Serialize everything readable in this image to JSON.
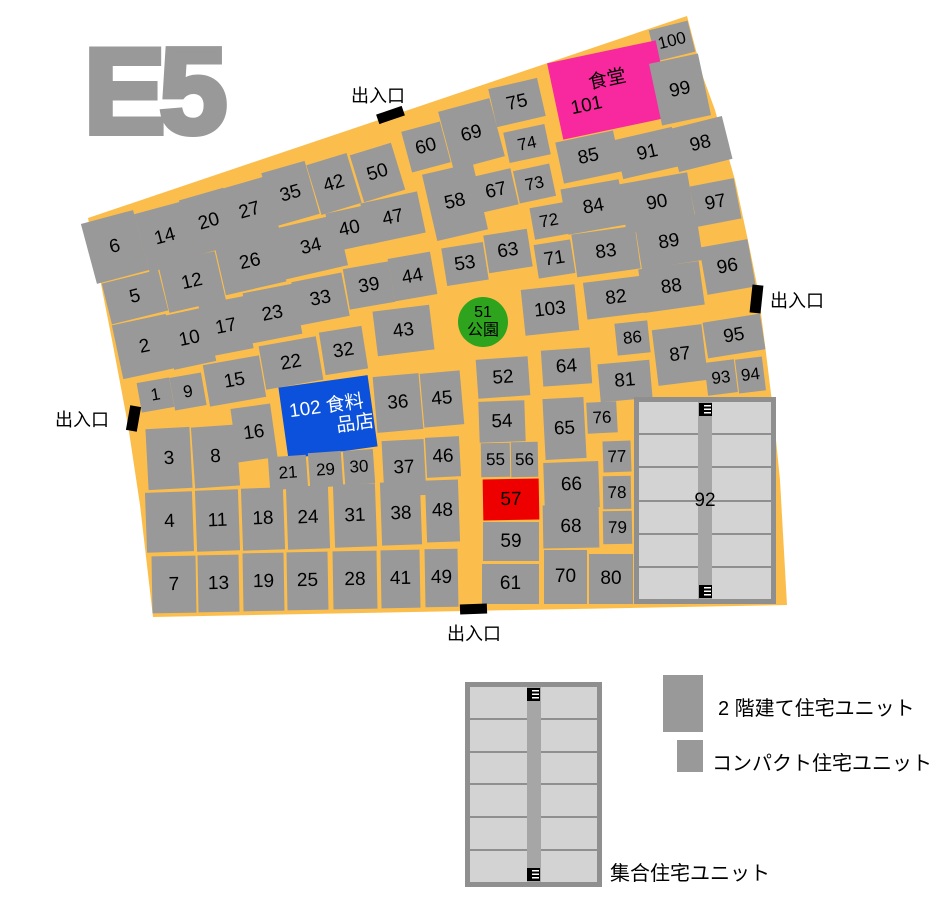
{
  "title": "E5",
  "map": {
    "colors": {
      "street": "#FBBE4D",
      "block": "#999999",
      "park": "#2EA31E",
      "canteen": "#F8289E",
      "grocery": "#0B51DB",
      "highlight": "#EE0000",
      "collective_fill": "#D3D3D3",
      "collective_border": "#8F8F8F",
      "corridor": "#A6A6A6"
    },
    "outline": "88,218 687,16 703,77 715,110 735,180 750,250 758,290 766,353 773,410 780,480 787,605 465,611 153,617 140,505 128,425 112,340",
    "entrance_label": "出入口",
    "entrances": [
      {
        "side": "top",
        "tx": 351,
        "ty": 82,
        "bx": 377,
        "by": 110,
        "bw": 27,
        "bh": 10,
        "br": -19
      },
      {
        "side": "left",
        "tx": 55,
        "ty": 406,
        "bx": 128,
        "by": 406,
        "bw": 11,
        "bh": 25,
        "br": 10
      },
      {
        "side": "right",
        "tx": 770,
        "ty": 287,
        "bx": 751,
        "by": 285,
        "bw": 11,
        "bh": 28,
        "br": 6
      },
      {
        "side": "bottom",
        "tx": 447,
        "ty": 620,
        "bx": 460,
        "by": 604,
        "bw": 27,
        "bh": 10,
        "br": -2
      }
    ],
    "blocks": [
      {
        "l": "6",
        "x": 88,
        "y": 216,
        "w": 54,
        "h": 62,
        "r": -15
      },
      {
        "l": "14",
        "x": 141,
        "y": 207,
        "w": 48,
        "h": 60,
        "r": -15
      },
      {
        "l": "20",
        "x": 186,
        "y": 193,
        "w": 46,
        "h": 58,
        "r": -16
      },
      {
        "l": "27",
        "x": 226,
        "y": 182,
        "w": 47,
        "h": 57,
        "r": -16
      },
      {
        "l": "35",
        "x": 268,
        "y": 166,
        "w": 45,
        "h": 55,
        "r": -16
      },
      {
        "l": "42",
        "x": 313,
        "y": 158,
        "w": 42,
        "h": 52,
        "r": -17
      },
      {
        "l": "50",
        "x": 356,
        "y": 148,
        "w": 43,
        "h": 49,
        "r": -17
      },
      {
        "l": "60",
        "x": 406,
        "y": 126,
        "w": 40,
        "h": 42,
        "r": -15
      },
      {
        "l": "69",
        "x": 445,
        "y": 104,
        "w": 53,
        "h": 60,
        "r": -15
      },
      {
        "l": "75",
        "x": 492,
        "y": 83,
        "w": 50,
        "h": 39,
        "r": -13
      },
      {
        "l": "100",
        "x": 652,
        "y": 25,
        "w": 40,
        "h": 32,
        "r": -14,
        "fs": 17
      },
      {
        "l": "101",
        "x": 554,
        "y": 51,
        "w": 111,
        "h": 78,
        "r": -12,
        "c": "canteen",
        "lines": [
          "食堂",
          "101"
        ],
        "align": [
          "center",
          "left"
        ],
        "name": "canteen-block-101"
      },
      {
        "l": "99",
        "x": 655,
        "y": 58,
        "w": 50,
        "h": 63,
        "r": -12
      },
      {
        "l": "5",
        "x": 106,
        "y": 276,
        "w": 58,
        "h": 42,
        "r": -14
      },
      {
        "l": "12",
        "x": 163,
        "y": 257,
        "w": 58,
        "h": 50,
        "r": -13
      },
      {
        "l": "26",
        "x": 219,
        "y": 234,
        "w": 62,
        "h": 55,
        "r": -13
      },
      {
        "l": "34",
        "x": 279,
        "y": 221,
        "w": 64,
        "h": 52,
        "r": -13
      },
      {
        "l": "40",
        "x": 329,
        "y": 209,
        "w": 41,
        "h": 39,
        "r": -12
      },
      {
        "l": "47",
        "x": 364,
        "y": 197,
        "w": 58,
        "h": 42,
        "r": -12
      },
      {
        "l": "58",
        "x": 429,
        "y": 168,
        "w": 52,
        "h": 68,
        "r": -13
      },
      {
        "l": "67",
        "x": 477,
        "y": 172,
        "w": 38,
        "h": 37,
        "r": -13
      },
      {
        "l": "74",
        "x": 506,
        "y": 128,
        "w": 42,
        "h": 31,
        "r": -12,
        "fs": 17
      },
      {
        "l": "73",
        "x": 516,
        "y": 167,
        "w": 37,
        "h": 33,
        "r": -12,
        "fs": 17
      },
      {
        "l": "2",
        "x": 117,
        "y": 319,
        "w": 55,
        "h": 55,
        "r": -12
      },
      {
        "l": "10",
        "x": 168,
        "y": 311,
        "w": 43,
        "h": 55,
        "r": -12
      },
      {
        "l": "17",
        "x": 203,
        "y": 300,
        "w": 46,
        "h": 53,
        "r": -11
      },
      {
        "l": "23",
        "x": 247,
        "y": 288,
        "w": 51,
        "h": 51,
        "r": -11
      },
      {
        "l": "33",
        "x": 295,
        "y": 277,
        "w": 51,
        "h": 44,
        "r": -11
      },
      {
        "l": "39",
        "x": 346,
        "y": 265,
        "w": 46,
        "h": 41,
        "r": -10
      },
      {
        "l": "44",
        "x": 391,
        "y": 255,
        "w": 43,
        "h": 43,
        "r": -10
      },
      {
        "l": "53",
        "x": 444,
        "y": 245,
        "w": 42,
        "h": 38,
        "r": -9
      },
      {
        "l": "63",
        "x": 486,
        "y": 232,
        "w": 44,
        "h": 38,
        "r": -9
      },
      {
        "l": "72",
        "x": 532,
        "y": 205,
        "w": 34,
        "h": 32,
        "r": -10,
        "fs": 17
      },
      {
        "l": "71",
        "x": 536,
        "y": 242,
        "w": 37,
        "h": 34,
        "r": -9
      },
      {
        "l": "85",
        "x": 559,
        "y": 136,
        "w": 59,
        "h": 42,
        "r": -12
      },
      {
        "l": "91",
        "x": 618,
        "y": 133,
        "w": 59,
        "h": 40,
        "r": -13
      },
      {
        "l": "98",
        "x": 673,
        "y": 122,
        "w": 55,
        "h": 44,
        "r": -14
      },
      {
        "l": "84",
        "x": 564,
        "y": 184,
        "w": 59,
        "h": 46,
        "r": -10
      },
      {
        "l": "90",
        "x": 622,
        "y": 178,
        "w": 70,
        "h": 50,
        "r": -10
      },
      {
        "l": "97",
        "x": 693,
        "y": 182,
        "w": 45,
        "h": 41,
        "r": -11
      },
      {
        "l": "83",
        "x": 574,
        "y": 230,
        "w": 64,
        "h": 43,
        "r": -8
      },
      {
        "l": "89",
        "x": 638,
        "y": 219,
        "w": 62,
        "h": 46,
        "r": -9
      },
      {
        "l": "88",
        "x": 641,
        "y": 265,
        "w": 61,
        "h": 44,
        "r": -8
      },
      {
        "l": "96",
        "x": 703,
        "y": 243,
        "w": 49,
        "h": 48,
        "r": -10
      },
      {
        "l": "1",
        "x": 139,
        "y": 380,
        "w": 33,
        "h": 30,
        "r": -10,
        "fs": 17
      },
      {
        "l": "9",
        "x": 172,
        "y": 375,
        "w": 32,
        "h": 33,
        "r": -10,
        "fs": 17
      },
      {
        "l": "15",
        "x": 206,
        "y": 360,
        "w": 57,
        "h": 42,
        "r": -10
      },
      {
        "l": "22",
        "x": 262,
        "y": 341,
        "w": 58,
        "h": 44,
        "r": -10
      },
      {
        "l": "32",
        "x": 322,
        "y": 329,
        "w": 43,
        "h": 43,
        "r": -9
      },
      {
        "l": "43",
        "x": 375,
        "y": 308,
        "w": 57,
        "h": 45,
        "r": -7
      },
      {
        "l": "51",
        "x": 458,
        "y": 297,
        "w": 50,
        "h": 50,
        "r": 0,
        "c": "park",
        "shape": "circle",
        "lines": [
          "51",
          "公園"
        ],
        "fs": 16,
        "name": "park-block-51"
      },
      {
        "l": "103",
        "x": 523,
        "y": 287,
        "w": 54,
        "h": 46,
        "r": -6
      },
      {
        "l": "82",
        "x": 585,
        "y": 279,
        "w": 62,
        "h": 37,
        "r": -7
      },
      {
        "l": "86",
        "x": 616,
        "y": 322,
        "w": 33,
        "h": 32,
        "r": -6,
        "fs": 17
      },
      {
        "l": "81",
        "x": 599,
        "y": 362,
        "w": 52,
        "h": 38,
        "r": -5
      },
      {
        "l": "87",
        "x": 655,
        "y": 327,
        "w": 50,
        "h": 56,
        "r": -7
      },
      {
        "l": "95",
        "x": 705,
        "y": 318,
        "w": 58,
        "h": 36,
        "r": -9
      },
      {
        "l": "93",
        "x": 706,
        "y": 361,
        "w": 30,
        "h": 33,
        "r": -7,
        "fs": 17
      },
      {
        "l": "94",
        "x": 737,
        "y": 358,
        "w": 27,
        "h": 34,
        "r": -7,
        "fs": 17
      },
      {
        "l": "16",
        "x": 234,
        "y": 406,
        "w": 40,
        "h": 54,
        "r": -8
      },
      {
        "l": "102",
        "x": 283,
        "y": 381,
        "w": 90,
        "h": 72,
        "r": -8,
        "c": "grocery",
        "tc": "#ffffff",
        "lines": [
          "102 食料",
          "品店"
        ],
        "align": [
          "center",
          "right"
        ],
        "name": "grocery-block-102"
      },
      {
        "l": "36",
        "x": 375,
        "y": 375,
        "w": 46,
        "h": 56,
        "r": -5
      },
      {
        "l": "45",
        "x": 422,
        "y": 372,
        "w": 40,
        "h": 54,
        "r": -5
      },
      {
        "l": "52",
        "x": 477,
        "y": 358,
        "w": 52,
        "h": 39,
        "r": -4
      },
      {
        "l": "64",
        "x": 542,
        "y": 349,
        "w": 49,
        "h": 36,
        "r": -4
      },
      {
        "l": "54",
        "x": 479,
        "y": 401,
        "w": 46,
        "h": 41,
        "r": -2
      },
      {
        "l": "65",
        "x": 544,
        "y": 398,
        "w": 41,
        "h": 61,
        "r": -3
      },
      {
        "l": "76",
        "x": 587,
        "y": 402,
        "w": 30,
        "h": 31,
        "r": -3,
        "fs": 17
      },
      {
        "l": "3",
        "x": 147,
        "y": 428,
        "w": 44,
        "h": 61,
        "r": -3
      },
      {
        "l": "8",
        "x": 193,
        "y": 426,
        "w": 45,
        "h": 61,
        "r": -4
      },
      {
        "l": "21",
        "x": 269,
        "y": 456,
        "w": 38,
        "h": 33,
        "r": -4,
        "fs": 17
      },
      {
        "l": "29",
        "x": 309,
        "y": 452,
        "w": 33,
        "h": 35,
        "r": -4,
        "fs": 17
      },
      {
        "l": "30",
        "x": 344,
        "y": 450,
        "w": 30,
        "h": 34,
        "r": -4,
        "fs": 17
      },
      {
        "l": "37",
        "x": 383,
        "y": 440,
        "w": 42,
        "h": 56,
        "r": -3
      },
      {
        "l": "46",
        "x": 426,
        "y": 437,
        "w": 34,
        "h": 40,
        "r": -3
      },
      {
        "l": "55",
        "x": 481,
        "y": 443,
        "w": 29,
        "h": 34,
        "r": -1,
        "fs": 17
      },
      {
        "l": "56",
        "x": 511,
        "y": 442,
        "w": 27,
        "h": 35,
        "r": -1,
        "fs": 17
      },
      {
        "l": "77",
        "x": 603,
        "y": 441,
        "w": 28,
        "h": 31,
        "r": -2,
        "fs": 17
      },
      {
        "l": "78",
        "x": 603,
        "y": 476,
        "w": 28,
        "h": 33,
        "r": -1,
        "fs": 17
      },
      {
        "l": "79",
        "x": 603,
        "y": 511,
        "w": 29,
        "h": 33,
        "r": -1,
        "fs": 17
      },
      {
        "l": "57",
        "x": 483,
        "y": 479,
        "w": 56,
        "h": 41,
        "r": -1,
        "c": "highlight",
        "name": "highlighted-block-57"
      },
      {
        "l": "66",
        "x": 544,
        "y": 462,
        "w": 55,
        "h": 46,
        "r": -2
      },
      {
        "l": "68",
        "x": 543,
        "y": 505,
        "w": 56,
        "h": 43,
        "r": -1
      },
      {
        "l": "59",
        "x": 483,
        "y": 522,
        "w": 56,
        "h": 39,
        "r": 0
      },
      {
        "l": "4",
        "x": 146,
        "y": 492,
        "w": 47,
        "h": 60,
        "r": -2
      },
      {
        "l": "11",
        "x": 196,
        "y": 490,
        "w": 43,
        "h": 61,
        "r": -2
      },
      {
        "l": "18",
        "x": 242,
        "y": 488,
        "w": 42,
        "h": 62,
        "r": -2
      },
      {
        "l": "24",
        "x": 287,
        "y": 486,
        "w": 42,
        "h": 63,
        "r": -2
      },
      {
        "l": "31",
        "x": 334,
        "y": 484,
        "w": 42,
        "h": 63,
        "r": -2
      },
      {
        "l": "38",
        "x": 381,
        "y": 482,
        "w": 40,
        "h": 63,
        "r": -2
      },
      {
        "l": "48",
        "x": 426,
        "y": 480,
        "w": 33,
        "h": 62,
        "r": -2
      },
      {
        "l": "7",
        "x": 152,
        "y": 556,
        "w": 44,
        "h": 57,
        "r": -1
      },
      {
        "l": "13",
        "x": 198,
        "y": 555,
        "w": 41,
        "h": 57,
        "r": -1
      },
      {
        "l": "19",
        "x": 243,
        "y": 553,
        "w": 41,
        "h": 58,
        "r": -1
      },
      {
        "l": "25",
        "x": 287,
        "y": 552,
        "w": 41,
        "h": 58,
        "r": -1
      },
      {
        "l": "28",
        "x": 333,
        "y": 551,
        "w": 44,
        "h": 58,
        "r": -1
      },
      {
        "l": "41",
        "x": 381,
        "y": 550,
        "w": 39,
        "h": 58,
        "r": -1
      },
      {
        "l": "49",
        "x": 425,
        "y": 549,
        "w": 33,
        "h": 58,
        "r": -1
      },
      {
        "l": "61",
        "x": 482,
        "y": 564,
        "w": 57,
        "h": 40,
        "r": 0
      },
      {
        "l": "70",
        "x": 544,
        "y": 550,
        "w": 43,
        "h": 54,
        "r": 0
      },
      {
        "l": "80",
        "x": 589,
        "y": 554,
        "w": 44,
        "h": 50,
        "r": 0
      },
      {
        "l": "92",
        "x": 634,
        "y": 397,
        "w": 142,
        "h": 207,
        "r": 0,
        "type": "collective",
        "name": "collective-block-92"
      }
    ]
  },
  "legend": {
    "two_story": "2 階建て住宅ユニット",
    "compact": "コンパクト住宅ユニット",
    "collective": "集合住宅ユニット"
  }
}
